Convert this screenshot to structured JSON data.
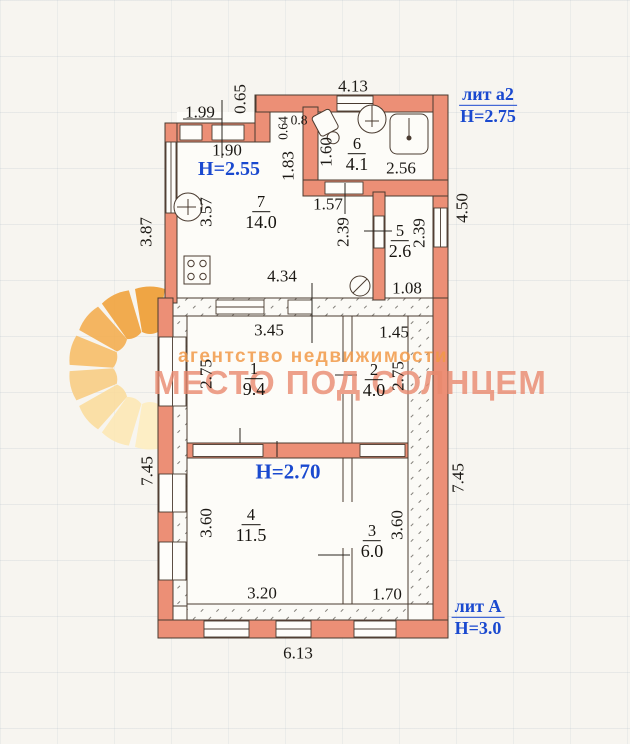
{
  "annotations": {
    "lit_a2": "лит а2",
    "h_a2": "Н=2.75",
    "h_255": "Н=2.55",
    "h_270": "Н=2.70",
    "lit_A": "лит А",
    "h_A": "Н=3.0"
  },
  "watermark": {
    "line1": "агентство недвижимости",
    "line2": "МЕСТО ПОД СОЛНЦЕМ"
  },
  "rooms": {
    "r1": {
      "num": "1",
      "area": "9.4"
    },
    "r2": {
      "num": "2",
      "area": "4.0"
    },
    "r3": {
      "num": "3",
      "area": "6.0"
    },
    "r4": {
      "num": "4",
      "area": "11.5"
    },
    "r5": {
      "num": "5",
      "area": "2.6"
    },
    "r6": {
      "num": "6",
      "area": "4.1"
    },
    "r7": {
      "num": "7",
      "area": "14.0"
    }
  },
  "dims": {
    "d199": "1.99",
    "d065": "0.65",
    "d413": "4.13",
    "d08": "0.8",
    "d064": "0.64",
    "d183": "1.83",
    "d190": "1.90",
    "d357": "3.57",
    "d157": "1.57",
    "d239_hall": "2.39",
    "d160": "1.60",
    "d256": "2.56",
    "d239_r5": "2.39",
    "d108": "1.08",
    "d434": "4.34",
    "d450": "4.50",
    "d387": "3.87",
    "d345": "3.45",
    "d145": "1.45",
    "d275_l": "2.75",
    "d275_r": "2.75",
    "d360_l": "3.60",
    "d360_r": "3.60",
    "d320": "3.20",
    "d170": "1.70",
    "d745_l": "7.45",
    "d745_r": "7.45",
    "d613": "6.13"
  },
  "colors": {
    "wall_fill": "#ec8f76",
    "wall_outline": "#4a3b30",
    "blue_label": "#1a49cf",
    "watermark_orange": "#f19948",
    "watermark_salmon": "#e9886e",
    "sun_orange": "#ef9b2d",
    "sun_pale": "#feeec0"
  }
}
